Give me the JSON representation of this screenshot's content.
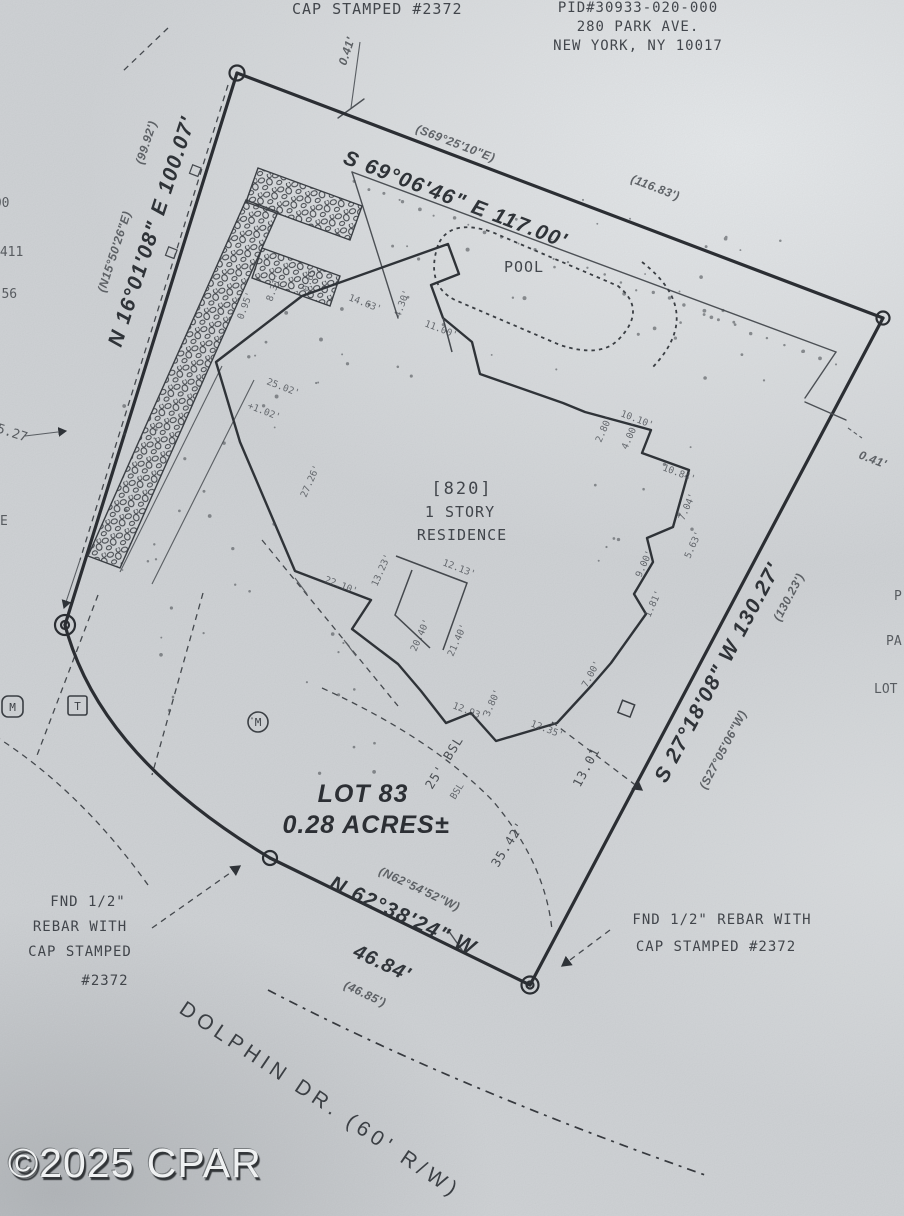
{
  "paper": {
    "background": "#d2d5d8",
    "ink": "#2f3338",
    "faint_ink": "#4a4e54"
  },
  "header": {
    "cap_line": "CAP STAMPED #2372",
    "pid": "PID#30933-020-000",
    "addr1": "280 PARK AVE.",
    "addr2": "NEW YORK, NY 10017",
    "tick_offset": "0.41'"
  },
  "boundaries": {
    "north": {
      "record_bearing": "(S69°25'10\"E)",
      "bearing": "S 69°06'46\" E 117.00'",
      "record_distance": "(116.83')"
    },
    "west": {
      "record_distance": "(99.92')",
      "record_bearing": "(N15°50'26\"E)",
      "bearing": "N 16°01'08\" E 100.07'"
    },
    "east": {
      "record_distance": "(130.23')",
      "bearing": "S 27°18'08\" W 130.27'",
      "record_bearing": "(S27°05'06\"W)",
      "tick_offset": "0.41'"
    },
    "south": {
      "record_bearing": "(N62°54'52\"W)",
      "bearing": "N 62°38'24\" W",
      "distance": "46.84'",
      "record_distance": "(46.85')"
    }
  },
  "site": {
    "pool": "POOL",
    "house_number": "[820]",
    "house_desc1": "1 STORY",
    "house_desc2": "RESIDENCE",
    "lot": "LOT 83",
    "area": "0.28 ACRES±",
    "setback": "25' BSL",
    "setback_small": "BSL",
    "setback_length": "35.42'",
    "setback_tie": "13.01"
  },
  "monuments": {
    "left": [
      "FND 1/2\"",
      "REBAR WITH",
      "CAP STAMPED",
      "#2372"
    ],
    "right": [
      "FND 1/2\" REBAR WITH",
      "CAP STAMPED #2372"
    ]
  },
  "street": {
    "name": "DOLPHIN DR. (60' R/W)"
  },
  "watermark": "©2025 CPAR",
  "symbols": {
    "meter": "M",
    "telephone": "T",
    "meter2": "M"
  },
  "edge_fragments": {
    "left": [
      "000",
      "2411",
      "57-56",
      "5.27",
      "E"
    ],
    "right": [
      "P",
      "PA",
      "LOT"
    ]
  },
  "dims": [
    {
      "t": "0.95'",
      "x": 243,
      "y": 320,
      "r": -70
    },
    {
      "t": "8.31'",
      "x": 272,
      "y": 302,
      "r": -70
    },
    {
      "t": "0.65'",
      "x": 308,
      "y": 292,
      "r": -70
    },
    {
      "t": "14.63'",
      "x": 348,
      "y": 300,
      "r": 21
    },
    {
      "t": "4.30'",
      "x": 400,
      "y": 318,
      "r": -70
    },
    {
      "t": "11.00'",
      "x": 424,
      "y": 326,
      "r": 21
    },
    {
      "t": "10.10'",
      "x": 620,
      "y": 416,
      "r": 21
    },
    {
      "t": "2.80'",
      "x": 601,
      "y": 443,
      "r": -66
    },
    {
      "t": "4.00'",
      "x": 627,
      "y": 450,
      "r": -66
    },
    {
      "t": "10.84'",
      "x": 662,
      "y": 470,
      "r": 21
    },
    {
      "t": "7.04'",
      "x": 684,
      "y": 521,
      "r": -66
    },
    {
      "t": "5.63'",
      "x": 690,
      "y": 559,
      "r": -66
    },
    {
      "t": "9.00'",
      "x": 641,
      "y": 578,
      "r": -66
    },
    {
      "t": "1.81'",
      "x": 650,
      "y": 618,
      "r": -66
    },
    {
      "t": "25.02'",
      "x": 266,
      "y": 384,
      "r": 21
    },
    {
      "t": "+1.02'",
      "x": 247,
      "y": 408,
      "r": 21
    },
    {
      "t": "27.26'",
      "x": 306,
      "y": 498,
      "r": -66
    },
    {
      "t": "22.10'",
      "x": 324,
      "y": 582,
      "r": 21
    },
    {
      "t": "13.23'",
      "x": 377,
      "y": 587,
      "r": -66
    },
    {
      "t": "12.13'",
      "x": 442,
      "y": 565,
      "r": 21
    },
    {
      "t": "20.40'",
      "x": 416,
      "y": 652,
      "r": -66
    },
    {
      "t": "21.40'",
      "x": 453,
      "y": 657,
      "r": -66
    },
    {
      "t": "12.93'",
      "x": 452,
      "y": 708,
      "r": 21
    },
    {
      "t": "3.80'",
      "x": 489,
      "y": 717,
      "r": -66
    },
    {
      "t": "12.35'",
      "x": 530,
      "y": 726,
      "r": 21
    },
    {
      "t": "7.00'",
      "x": 587,
      "y": 688,
      "r": -62
    }
  ]
}
